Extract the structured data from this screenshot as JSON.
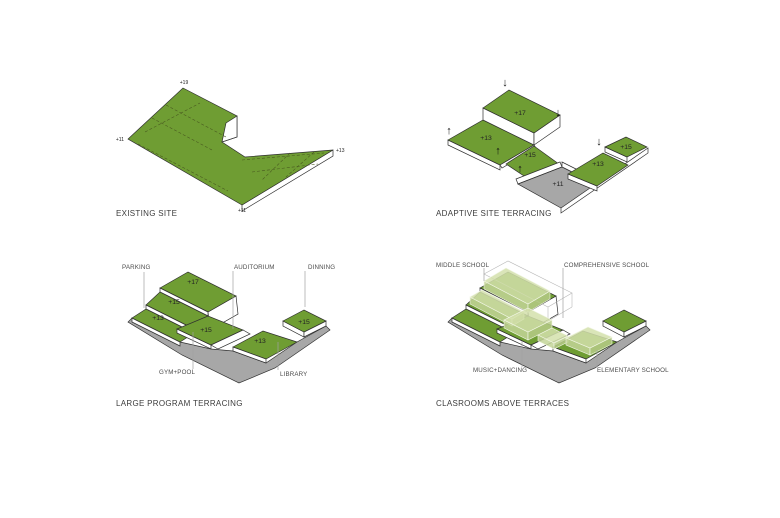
{
  "canvas": {
    "background": "#ffffff"
  },
  "colors": {
    "terrace_green": "#6f9d33",
    "platform_gray": "#a7a7a7",
    "outline": "#2f2f2f",
    "classroom_fill": "#d3e0ac",
    "label_gray": "#4c4c4c"
  },
  "panels": {
    "existing_site": {
      "caption": "EXISTING SITE",
      "elevations": {
        "peak": "+19",
        "left": "+11",
        "right": "+13",
        "bottom": "+11"
      }
    },
    "adaptive_terracing": {
      "caption": "ADAPTIVE SITE TERRACING",
      "elevations": {
        "upper": "+17",
        "left": "+13",
        "mid": "+15",
        "low": "+11",
        "right": "+13",
        "far_right": "+15"
      },
      "icons": {
        "arrow_up": "↑",
        "arrow_down": "↓"
      }
    },
    "large_program": {
      "caption": "LARGE PROGRAM TERRACING",
      "elevations": {
        "upper": "+17",
        "upper_mid": "+15",
        "left": "+13",
        "mid": "+15",
        "right": "+13",
        "far_right": "+15"
      },
      "labels": {
        "parking": "PARKING",
        "auditorium": "AUDITORIUM",
        "dinning": "DINNING",
        "gym_pool": "GYM+POOL",
        "library": "LIBRARY"
      }
    },
    "classrooms_above": {
      "caption": "CLASROOMS ABOVE TERRACES",
      "labels": {
        "middle_school": "MIDDLE SCHOOL",
        "comprehensive_school": "COMPREHENSIVE SCHOOL",
        "music_dancing": "MUSIC+DANCING",
        "elementary_school": "ELEMENTARY SCHOOL"
      }
    }
  }
}
